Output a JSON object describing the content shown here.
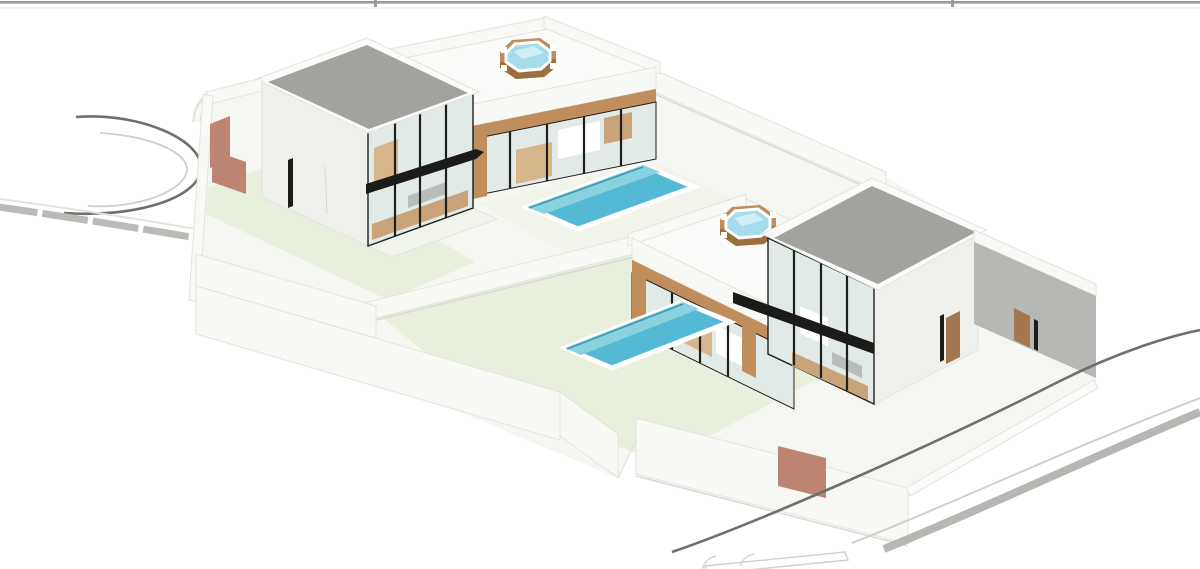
{
  "meta": {
    "description": "Isometric 3D architectural rendering of two modern two-storey villas, each with a glass facade, a single-storey wing with roof-terrace jacuzzi, a private swimming pool, perimeter walls with terracotta gates, a roundabout street on the left and a curved street at the bottom right"
  },
  "scene": {
    "villa_count": 2,
    "pool_count": 2,
    "jacuzzi_count": 2,
    "features": [
      "two-storey glass-facade villa (left)",
      "two-storey glass-facade villa (right)",
      "roof terrace with jacuzzi on each single-storey wing",
      "private pool per plot",
      "white perimeter walls with terracotta gates",
      "roundabout street (left)",
      "curved street with sidewalk (bottom right)"
    ]
  },
  "chrome": {
    "top_border": "cropped-window-edge"
  },
  "colors": {
    "background": "#ffffff",
    "top_line": "#9a9a9a",
    "top_line_faint": "#e9e9e9",
    "backdrop": "#f5f6f2",
    "wall_white": "#f8f8f5",
    "wall_face": "#efefec",
    "wall_edge": "#e2e2de",
    "wall_shadow": "#d8d8d4",
    "wall_dark_face": "#b7b8b4",
    "lawn": "#e8efdc",
    "deck": "#f1f4ea",
    "roof_gray": "#a2a39f",
    "fascia_white": "#fbfbf9",
    "glass": "#e2eae8",
    "mullion": "#1f1f1d",
    "slab_black": "#1b1b19",
    "wood": "#bf8e5c",
    "wood_dark": "#9c6f3f",
    "door_wood": "#a4764f",
    "gate_salmon": "#bd8472",
    "pool_water": "#54b9d4",
    "pool_water_light": "#8ad2e0",
    "pool_edge": "#3f97b2",
    "jacuzzi_water": "#a5dcea",
    "jacuzzi_water_light": "#d2eef5",
    "interior_tan": "#d8b68c",
    "interior_tan_dark": "#c9a379",
    "interior_gray": "#b9bdb9",
    "road_dark": "#6f6f6f",
    "road_mid": "#b4b7b2",
    "road_light": "#cfcfcc",
    "curb": "#b9bcb6",
    "white": "#ffffff"
  }
}
